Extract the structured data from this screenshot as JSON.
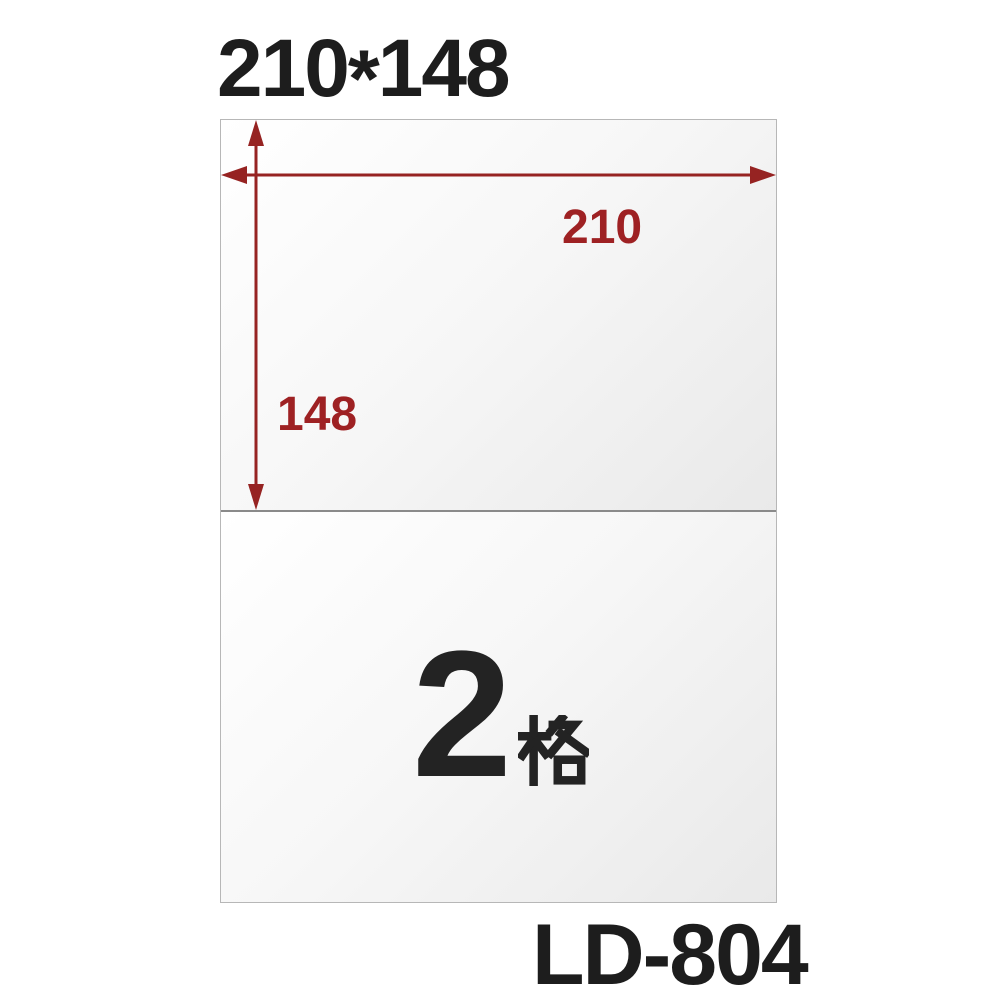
{
  "page": {
    "background_color": "#ffffff",
    "title": "210*148",
    "title_parts": {
      "width": "210",
      "separator": "*",
      "height": "148"
    },
    "product_code": "LD-804"
  },
  "sheet": {
    "width_dimension_label": "210",
    "height_dimension_label": "148",
    "cells_label": "2格",
    "cell_count": "2",
    "cell_unit": "格",
    "cell_layout": "2 horizontal cells stacked vertically"
  },
  "colors": {
    "dimension_text": "#9e2123",
    "dimension_arrow": "#962322",
    "heading_text": "#1d1d1d",
    "cell_label_text": "#232323",
    "sheet_border": "#b7b7b7",
    "cell_divider": "#8a8a8a",
    "sheet_gradient_start": "#ffffff",
    "sheet_gradient_end": "#e9e9e9"
  }
}
